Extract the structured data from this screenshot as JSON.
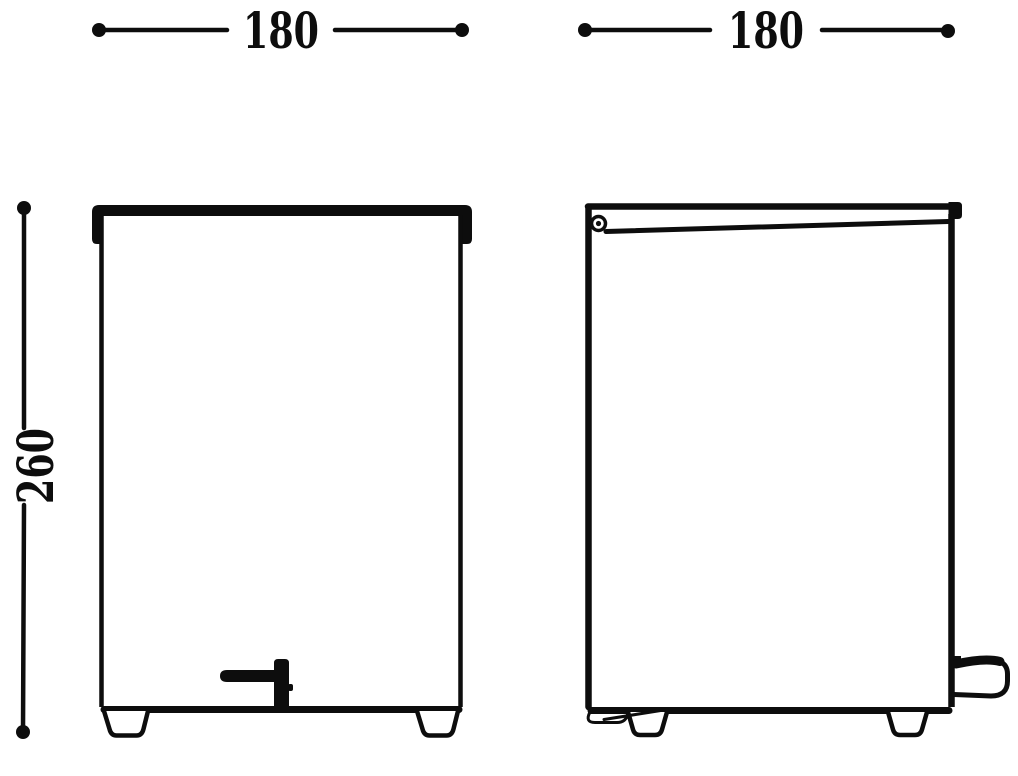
{
  "drawing": {
    "kind": "dimensioned technical drawing, two elevations of a pedal bin",
    "ink_color": "#0d0d0d",
    "background_color": "#ffffff",
    "dimensions": {
      "front_width": "180",
      "side_depth": "180",
      "height": "260"
    }
  }
}
